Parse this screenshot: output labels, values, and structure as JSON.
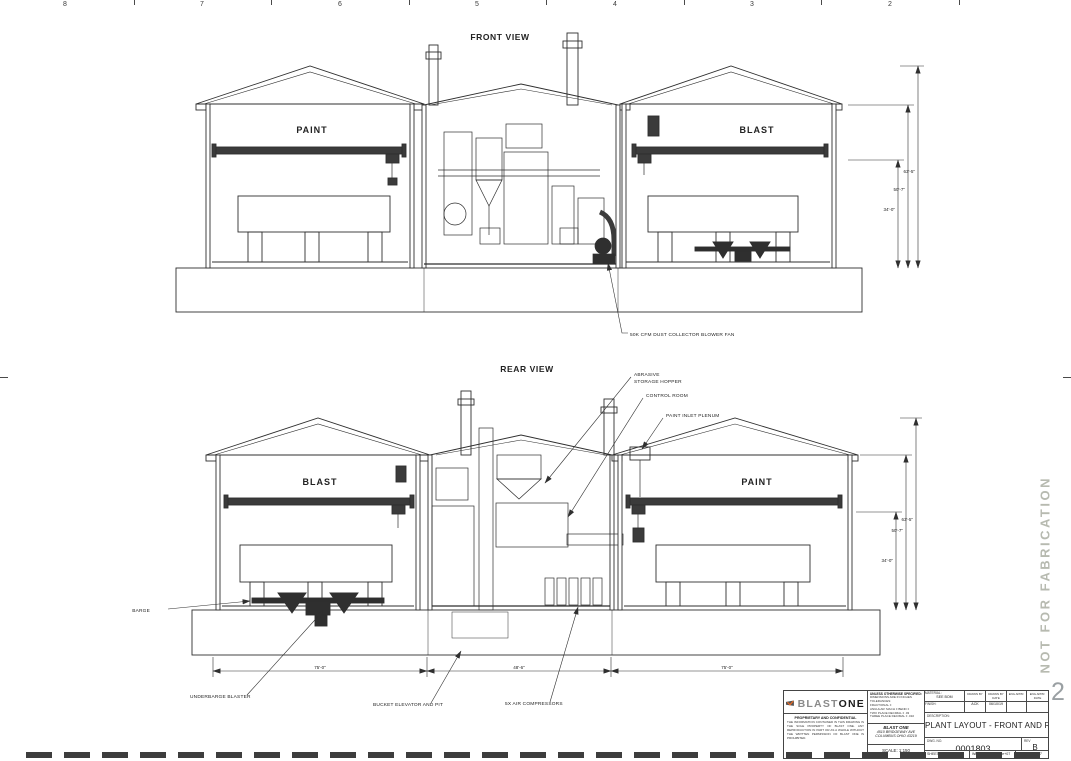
{
  "sheet": {
    "zone_labels": [
      "8",
      "7",
      "6",
      "5",
      "4",
      "3",
      "2"
    ],
    "corner_zone": "2",
    "stamp": "NOT FOR FABRICATION"
  },
  "front": {
    "title": "FRONT VIEW",
    "left_label": "PAINT",
    "right_label": "BLAST",
    "fan_callout": "50K CFM DUST COLLECTOR BLOWER FAN",
    "dims": {
      "inner": "34'-0\"",
      "middle": "50'-7\"",
      "outer": "63'-5\""
    }
  },
  "rear": {
    "title": "REAR VIEW",
    "left_label": "BLAST",
    "right_label": "PAINT",
    "callouts": {
      "abrasive_line1": "ABRASIVE",
      "abrasive_line2": "STORAGE HOPPER",
      "control_room": "CONTROL ROOM",
      "paint_inlet": "PAINT INLET PLENUM",
      "barge": "BARGE",
      "underbarge": "UNDERBARGE BLASTER",
      "bucket": "BUCKET ELEVATOR AND PIT",
      "compressors": "5X AIR COMPRESSORS"
    },
    "dims": {
      "inner": "34'-0\"",
      "middle": "50'-7\"",
      "outer": "63'-5\""
    },
    "width_dims": [
      "75'-0\"",
      "48'-6\"",
      "75'-0\""
    ]
  },
  "title_block": {
    "logo_text_1": "BLAST",
    "logo_text_2": "ONE",
    "proprietary_title": "PROPRIETARY AND CONFIDENTIAL",
    "proprietary_body": "THE INFORMATION CONTAINED IN THIS DRAWING IS THE SOLE PROPERTY OF BLAST ONE. ANY REPRODUCTION IN PART OR AS A WHOLE WITHOUT THE WRITTEN PERMISSION OF BLAST ONE IS PROHIBITED.",
    "spec_header": "UNLESS OTHERWISE SPECIFIED:",
    "spec_lines": [
      "DIMENSIONS ARE IN INCHES",
      "TOLERANCES:",
      "FRACTIONAL ±",
      "ANGULAR: MACH ±  BEND ±",
      "TWO PLACE DECIMAL    ± .03",
      "THREE PLACE DECIMAL  ± .010"
    ],
    "company_name": "BLAST ONE",
    "company_addr1": "4510 BRIDGEWAY AVE",
    "company_addr2": "COLUMBUS OHIO 43219",
    "scale": "SCALE: 1:150",
    "material_label": "MATERIAL:",
    "material_value": "SEE BOM",
    "finish_label": "FINISH:",
    "drawn_by_label": "DRAWN BY",
    "drawn_date_label": "DRAWN BY DATE",
    "eng_appr_label": "ENG APPR.",
    "eng_appr_date_label": "ENG APPR. DATE",
    "drawn_by_value": "ACK",
    "drawn_date_value": "06/10/19",
    "description_label": "DESCRIPTION:",
    "description": "PLANT LAYOUT - FRONT AND REAR",
    "dwg_no_label": "DWG. NO.",
    "dwg_no": "0001803",
    "rev_label": "REV",
    "rev": "B",
    "sheet_size_label": "SHEET SIZE",
    "sheet_size": "D",
    "weight_label": "WEIGHT:",
    "weight_value": "-2.14748e+07",
    "sheet_label": "SHEET 6 OF 7"
  },
  "colors": {
    "line": "#2f2f2f",
    "accent_orange": "#f26a21",
    "stamp_gray": "#b7bab0"
  }
}
